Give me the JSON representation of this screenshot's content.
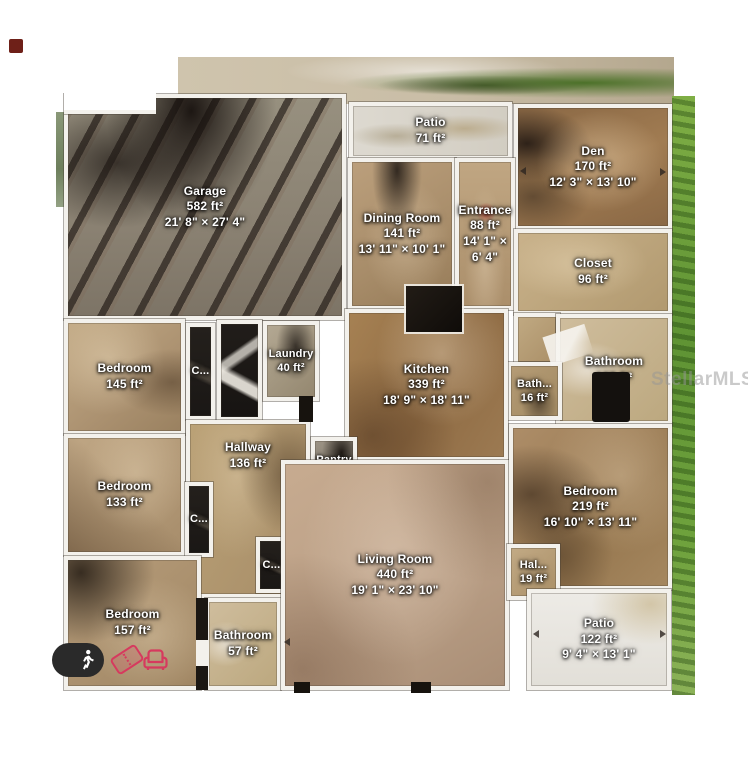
{
  "watermark": "StellarMLS",
  "plan": {
    "rooms": [
      {
        "name": "Garage",
        "area": "582 ft²",
        "dims": "21' 8\" × 27' 4\""
      },
      {
        "name": "Patio",
        "area": "71 ft²",
        "dims": ""
      },
      {
        "name": "Den",
        "area": "170 ft²",
        "dims": "12' 3\" × 13' 10\""
      },
      {
        "name": "Dining Room",
        "area": "141 ft²",
        "dims": "13' 11\" × 10' 1\""
      },
      {
        "name": "Entrance",
        "area": "88 ft²",
        "dims": "14' 1\" × 6' 4\""
      },
      {
        "name": "Closet",
        "area": "96 ft²",
        "dims": ""
      },
      {
        "name": "Bathroom",
        "area": "108 ft²",
        "dims": ""
      },
      {
        "name": "Bath...",
        "area": "16 ft²",
        "dims": ""
      },
      {
        "name": "Kitchen",
        "area": "339 ft²",
        "dims": "18' 9\" × 18' 11\""
      },
      {
        "name": "Bedroom",
        "area": "145 ft²",
        "dims": ""
      },
      {
        "name": "C...",
        "area": "",
        "dims": ""
      },
      {
        "name": "Laundry",
        "area": "40 ft²",
        "dims": ""
      },
      {
        "name": "Hallway",
        "area": "136 ft²",
        "dims": ""
      },
      {
        "name": "Pantry",
        "area": "14 ft²",
        "dims": ""
      },
      {
        "name": "Bedroom",
        "area": "133 ft²",
        "dims": ""
      },
      {
        "name": "C...",
        "area": "",
        "dims": ""
      },
      {
        "name": "C...",
        "area": "",
        "dims": ""
      },
      {
        "name": "Bedroom",
        "area": "157 ft²",
        "dims": ""
      },
      {
        "name": "Bathroom",
        "area": "57 ft²",
        "dims": ""
      },
      {
        "name": "Living Room",
        "area": "440 ft²",
        "dims": "19' 1\" × 23' 10\""
      },
      {
        "name": "Bedroom",
        "area": "219 ft²",
        "dims": "16' 10\" × 13' 11\""
      },
      {
        "name": "Hal...",
        "area": "19 ft²",
        "dims": ""
      },
      {
        "name": "Patio",
        "area": "122 ft²",
        "dims": "9' 4\" × 13' 1\""
      }
    ]
  },
  "controls": {
    "walk_icon": "walking-person-icon",
    "ticket_icon": "ticket-icon",
    "sofa_icon": "armchair-icon"
  },
  "colors": {
    "accent_red": "#d63a5e",
    "wall_white": "#f3f1ec",
    "closet_black": "#1e1b18",
    "grass_green": "#6aa23c",
    "watermark_gray": "#969696"
  }
}
